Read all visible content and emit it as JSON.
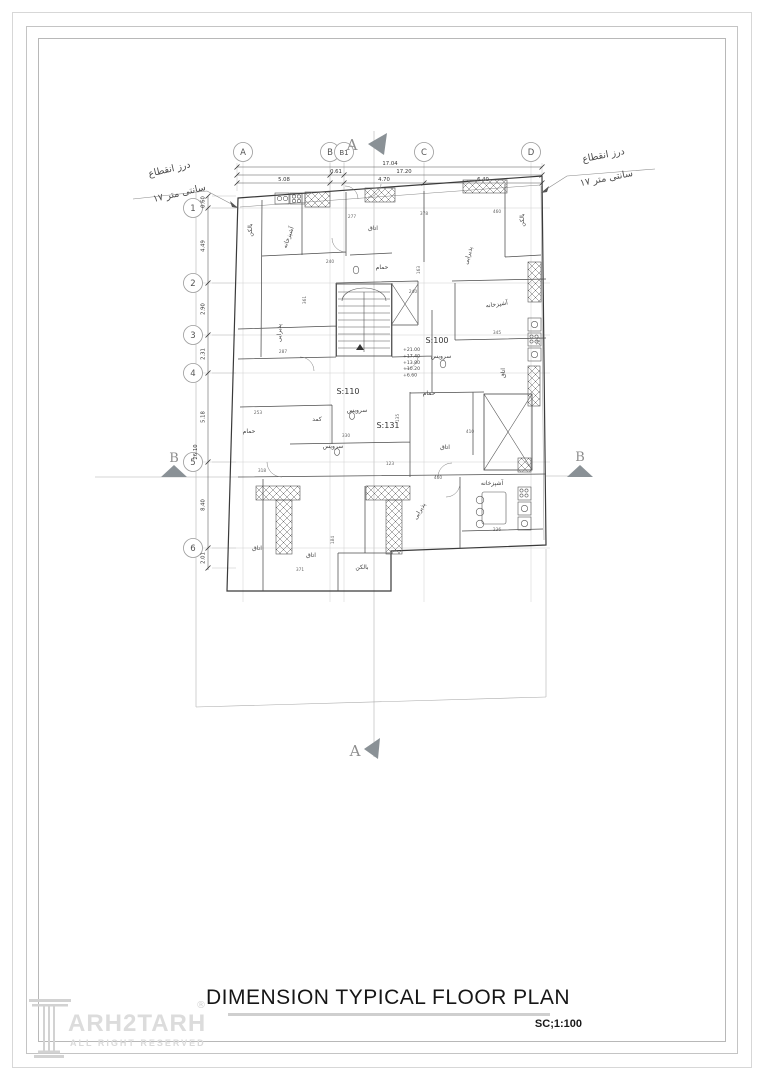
{
  "titleblock": {
    "title": "DIMENSION TYPICAL FLOOR PLAN",
    "scale": "SC;1:100"
  },
  "logo": {
    "text": "ARH2TARH",
    "sub": "ALL RIGHT RESERVED",
    "mark": "®"
  },
  "notes": {
    "left": {
      "l1": "درز انقطاع",
      "l2": "۱۷ سانتی متر"
    },
    "right": {
      "l1": "درز انقطاع",
      "l2": "۱۷ سانتی متر"
    }
  },
  "sections": {
    "a": "A",
    "b": "B"
  },
  "grid": {
    "top": [
      {
        "label": "A",
        "x": 243
      },
      {
        "label": "B",
        "x": 330
      },
      {
        "label": "B1",
        "x": 344
      },
      {
        "label": "C",
        "x": 424
      },
      {
        "label": "D",
        "x": 531
      }
    ],
    "left": [
      {
        "label": "1",
        "y": 208
      },
      {
        "label": "2",
        "y": 283
      },
      {
        "label": "3",
        "y": 335
      },
      {
        "label": "4",
        "y": 373
      },
      {
        "label": "5",
        "y": 462
      },
      {
        "label": "6",
        "y": 548
      }
    ]
  },
  "dims": {
    "top_rows": [
      {
        "y": 167,
        "x1": 237,
        "x2": 542,
        "ticks": [
          237,
          542
        ],
        "labels": [
          {
            "t": "17.04",
            "x": 390
          }
        ]
      },
      {
        "y": 175,
        "x1": 237,
        "x2": 542,
        "ticks": [
          237,
          330,
          344,
          542
        ],
        "labels": [
          {
            "t": "0.61",
            "x": 336
          },
          {
            "t": "17.20",
            "x": 404
          }
        ]
      },
      {
        "y": 183,
        "x1": 237,
        "x2": 542,
        "ticks": [
          237,
          330,
          344,
          424,
          542
        ],
        "labels": [
          {
            "t": "5.08",
            "x": 284
          },
          {
            "t": "4.70",
            "x": 384
          },
          {
            "t": "6.40",
            "x": 483
          }
        ]
      }
    ],
    "ext_xs": [
      237,
      330,
      344,
      424,
      542
    ],
    "left_col": {
      "x": 208,
      "y1": 196,
      "y2": 570,
      "ticks": [
        196,
        208,
        283,
        335,
        373,
        462,
        548,
        568
      ],
      "labels": [
        {
          "t": "0.60",
          "y": 202
        },
        {
          "t": "4.49",
          "y": 246
        },
        {
          "t": "2.90",
          "y": 309
        },
        {
          "t": "2.31",
          "y": 354
        },
        {
          "t": "5.18",
          "y": 417
        },
        {
          "t": "8.40",
          "y": 505
        },
        {
          "t": "2.01",
          "y": 558
        }
      ],
      "total": {
        "t": "26.10",
        "x": 197,
        "y": 452
      }
    }
  },
  "plan": {
    "units": [
      {
        "t": "S:100",
        "x": 437,
        "y": 343
      },
      {
        "t": "S:110",
        "x": 348,
        "y": 394
      },
      {
        "t": "S:131",
        "x": 388,
        "y": 428
      }
    ],
    "levels": {
      "x": 403,
      "y": 351,
      "lines": [
        "+21.00",
        "+17.40",
        "+13.80",
        "+10.20",
        "+6.60"
      ]
    },
    "rooms": [
      {
        "t": "بالکن",
        "x": 252,
        "y": 230,
        "r": -90
      },
      {
        "t": "آشپزخانه",
        "x": 290,
        "y": 238,
        "r": -70
      },
      {
        "t": "اتاق",
        "x": 373,
        "y": 230,
        "r": 0
      },
      {
        "t": "پذیرایی",
        "x": 470,
        "y": 256,
        "r": -75
      },
      {
        "t": "بالکن",
        "x": 524,
        "y": 220,
        "r": -90
      },
      {
        "t": "حمام",
        "x": 382,
        "y": 269,
        "r": 0
      },
      {
        "t": "آشپزخانه",
        "x": 497,
        "y": 306,
        "r": -8
      },
      {
        "t": "پذیرایی",
        "x": 281,
        "y": 333,
        "r": -90
      },
      {
        "t": "اتاق",
        "x": 505,
        "y": 373,
        "r": -90
      },
      {
        "t": "سرویس",
        "x": 441,
        "y": 358,
        "r": 0
      },
      {
        "t": "حمام",
        "x": 429,
        "y": 395,
        "r": 0
      },
      {
        "t": "سرویس",
        "x": 357,
        "y": 412,
        "r": 0
      },
      {
        "t": "کمد",
        "x": 317,
        "y": 421,
        "r": 0
      },
      {
        "t": "حمام",
        "x": 249,
        "y": 433,
        "r": 0
      },
      {
        "t": "سرویس",
        "x": 333,
        "y": 448,
        "r": 0
      },
      {
        "t": "اتاق",
        "x": 445,
        "y": 449,
        "r": 0
      },
      {
        "t": "آشپزخانه",
        "x": 492,
        "y": 485,
        "r": 0
      },
      {
        "t": "پذیرایی",
        "x": 421,
        "y": 512,
        "r": -60
      },
      {
        "t": "اتاق",
        "x": 257,
        "y": 550,
        "r": 0
      },
      {
        "t": "اتاق",
        "x": 311,
        "y": 557,
        "r": 0
      },
      {
        "t": "بالکن",
        "x": 362,
        "y": 569,
        "r": 0
      }
    ],
    "small_dims": [
      {
        "t": "277",
        "x": 352,
        "y": 218,
        "r": 0
      },
      {
        "t": "378",
        "x": 424,
        "y": 215,
        "r": 0
      },
      {
        "t": "460",
        "x": 497,
        "y": 213,
        "r": 0
      },
      {
        "t": "240",
        "x": 330,
        "y": 263,
        "r": 0
      },
      {
        "t": "163",
        "x": 420,
        "y": 270,
        "r": -90
      },
      {
        "t": "345",
        "x": 497,
        "y": 334,
        "r": 0
      },
      {
        "t": "361",
        "x": 306,
        "y": 300,
        "r": -90
      },
      {
        "t": "287",
        "x": 283,
        "y": 353,
        "r": 0
      },
      {
        "t": "253",
        "x": 258,
        "y": 414,
        "r": 0
      },
      {
        "t": "330",
        "x": 346,
        "y": 437,
        "r": 0
      },
      {
        "t": "135",
        "x": 399,
        "y": 418,
        "r": -90
      },
      {
        "t": "123",
        "x": 390,
        "y": 465,
        "r": 0
      },
      {
        "t": "410",
        "x": 470,
        "y": 433,
        "r": 0
      },
      {
        "t": "236",
        "x": 497,
        "y": 531,
        "r": 0
      },
      {
        "t": "460",
        "x": 438,
        "y": 479,
        "r": 0
      },
      {
        "t": "318",
        "x": 262,
        "y": 472,
        "r": 0
      },
      {
        "t": "371",
        "x": 300,
        "y": 571,
        "r": 0
      },
      {
        "t": "184",
        "x": 334,
        "y": 540,
        "r": -90
      },
      {
        "t": "285",
        "x": 540,
        "y": 341,
        "r": -90
      },
      {
        "t": "240",
        "x": 413,
        "y": 293,
        "r": 0
      }
    ]
  }
}
